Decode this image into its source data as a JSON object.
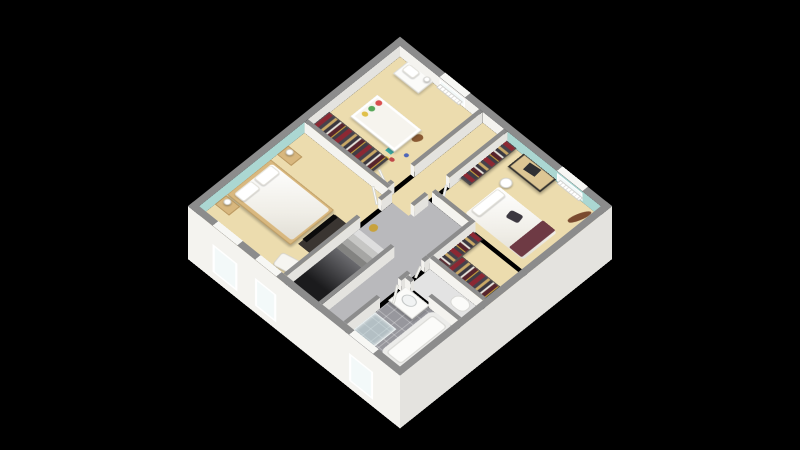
{
  "title": "3d-isometric-floor-plan-upper-storey",
  "canvas": {
    "width": 800,
    "height": 450,
    "background": "#000000"
  },
  "view": {
    "center_x": 400,
    "center_y": 217,
    "plan_size": 300,
    "tilt_deg": 37,
    "rotate_deg": 45,
    "wall_height": 18,
    "exterior_drop": 70
  },
  "palette": {
    "wall_top": "#8c8c8c",
    "wall_face": "#f4f3ef",
    "wall_face_shade": "#e4e3df",
    "teal": "#abd7d2",
    "beige": "#ecdcae",
    "hall_gray": "#b9b9bc",
    "wc_floor": "#e3e3e3",
    "window_seg": "#f7f7f4",
    "void_dark": "#1b1b1d",
    "void_light": "#6a6a6e",
    "clothes_red": "#8c2833",
    "clothes_dark": "#45424c",
    "clothes_tan": "#c9a866",
    "hanger_gold": "#d9b13f"
  },
  "rooms": [
    {
      "id": "nursery",
      "contents": "crib, changing dresser, open wardrobe, teddy bear, toys, radiator, window"
    },
    {
      "id": "corridor",
      "contents": "landing corridor to nursery and bedroom-2 doors"
    },
    {
      "id": "bedroom-2",
      "contents": "desk, stool, bed with maroon throw, open wardrobe, guitar, radiator, window, closet nook"
    },
    {
      "id": "master-bedroom",
      "contents": "double bed, two nightstands with lamps, tv, armchair, two windows, teal accent wall"
    },
    {
      "id": "hall",
      "contents": "staircase down, gold decor object"
    },
    {
      "id": "wc",
      "contents": "toilet"
    },
    {
      "id": "bathroom",
      "contents": "vanity sink, bathtub, shower, tiled floor, window"
    }
  ],
  "floors": [
    {
      "id": "hall-floor",
      "rect": [
        132,
        115,
        80,
        177
      ],
      "color": "hall_gray"
    },
    {
      "id": "nursery-floor",
      "rect": [
        8,
        8,
        112,
        130
      ],
      "color": "beige"
    },
    {
      "id": "corridor-floor",
      "rect": [
        125,
        8,
        30,
        135
      ],
      "color": "beige"
    },
    {
      "id": "bedroom2-floor",
      "rect": [
        160,
        8,
        132,
        102
      ],
      "color": "beige"
    },
    {
      "id": "closet-nook-floor",
      "rect": [
        217,
        115,
        75,
        55
      ],
      "color": "beige"
    },
    {
      "id": "master-floor",
      "rect": [
        8,
        143,
        119,
        149
      ],
      "color": "beige"
    },
    {
      "id": "wc-floor",
      "rect": [
        217,
        175,
        75,
        30
      ],
      "color": "wc_floor"
    },
    {
      "id": "bathroom-floor",
      "rect": [
        217,
        210,
        75,
        82
      ],
      "color": "",
      "cls": "tile"
    }
  ],
  "stairs": {
    "treads": [
      {
        "rect": [
          132,
          190,
          45,
          8
        ],
        "color": "#dedede"
      },
      {
        "rect": [
          132,
          198,
          45,
          8
        ],
        "color": "#c6c6c4"
      },
      {
        "rect": [
          132,
          206,
          45,
          8
        ],
        "color": "#a6a6a4"
      },
      {
        "rect": [
          132,
          214,
          45,
          8
        ],
        "color": "#838381"
      }
    ],
    "void": {
      "rect": [
        132,
        222,
        45,
        70
      ]
    }
  },
  "walls": [
    {
      "id": "exterior-wall-north",
      "rect": [
        0,
        0,
        300,
        8
      ],
      "faces": []
    },
    {
      "id": "exterior-wall-west",
      "rect": [
        0,
        0,
        8,
        300
      ],
      "faces": []
    },
    {
      "id": "exterior-wall-south",
      "rect": [
        0,
        292,
        300,
        8
      ],
      "faces": []
    },
    {
      "id": "exterior-wall-east",
      "rect": [
        292,
        0,
        8,
        300
      ],
      "faces": []
    },
    {
      "id": "nursery-east-wall",
      "rect": [
        120,
        8,
        5,
        97
      ],
      "faces": [
        "s",
        "e"
      ]
    },
    {
      "id": "nursery-east-wall-stub",
      "rect": [
        120,
        133,
        5,
        5
      ],
      "faces": [
        "s",
        "e"
      ]
    },
    {
      "id": "nursery-south-wall",
      "rect": [
        8,
        138,
        117,
        5
      ],
      "faces": [
        "s",
        "e"
      ]
    },
    {
      "id": "bedroom2-west-wall-a",
      "rect": [
        155,
        8,
        5,
        82
      ],
      "faces": [
        "s",
        "e"
      ]
    },
    {
      "id": "bedroom2-west-wall-b",
      "rect": [
        155,
        120,
        5,
        20
      ],
      "faces": [
        "s",
        "e"
      ]
    },
    {
      "id": "bedroom2-south-wall",
      "rect": [
        160,
        110,
        52,
        5
      ],
      "faces": [
        "s",
        "e"
      ]
    },
    {
      "id": "closet-nook-west-wall",
      "rect": [
        212,
        110,
        5,
        65
      ],
      "faces": [
        "s",
        "e"
      ]
    },
    {
      "id": "closet-nook-south-wall",
      "rect": [
        217,
        170,
        75,
        5
      ],
      "faces": [
        "s"
      ]
    },
    {
      "id": "wc-west-wall-a",
      "rect": [
        212,
        175,
        5,
        7
      ],
      "faces": [
        "s",
        "e"
      ]
    },
    {
      "id": "wc-west-wall-b",
      "rect": [
        212,
        202,
        5,
        13
      ],
      "faces": [
        "s",
        "e"
      ]
    },
    {
      "id": "bathroom-north-wall-a",
      "rect": [
        217,
        205,
        8,
        5
      ],
      "faces": [
        "s",
        "e"
      ]
    },
    {
      "id": "bathroom-north-wall-b",
      "rect": [
        250,
        205,
        42,
        5
      ],
      "faces": [
        "s"
      ]
    },
    {
      "id": "bathroom-west-wall",
      "rect": [
        212,
        245,
        5,
        47
      ],
      "faces": [
        "e"
      ]
    },
    {
      "id": "master-east-wall-a",
      "rect": [
        127,
        143,
        5,
        15
      ],
      "faces": [
        "s",
        "e"
      ]
    },
    {
      "id": "master-east-wall-b",
      "rect": [
        127,
        188,
        5,
        104
      ],
      "faces": [
        "e"
      ]
    },
    {
      "id": "stair-half-wall",
      "rect": [
        177,
        190,
        5,
        102
      ],
      "faces": [
        "e",
        "s"
      ]
    }
  ],
  "exterior_faces": [
    {
      "id": "exterior-face-south",
      "axis": "x",
      "x": 0,
      "y": 300,
      "len": 300,
      "color": "wall_face",
      "windows": [
        {
          "id": "master-window-1-panel",
          "at": 35,
          "w": 35
        },
        {
          "id": "master-window-2-panel",
          "at": 95,
          "w": 30
        },
        {
          "id": "bathroom-window-panel",
          "at": 228,
          "w": 34
        }
      ]
    },
    {
      "id": "exterior-face-east",
      "axis": "y",
      "x": 300,
      "y": 0,
      "len": 300,
      "color": "wall_face_shade",
      "windows": []
    }
  ],
  "inner_faces": [
    {
      "id": "nursery-north-wall-face",
      "axis": "x",
      "x": 8,
      "y": 8,
      "len": 112,
      "color": "wall_face",
      "win": {
        "at": 56,
        "w": 36
      }
    },
    {
      "id": "corridor-north-wall-face",
      "axis": "x",
      "x": 125,
      "y": 8,
      "len": 30,
      "color": "wall_face"
    },
    {
      "id": "bedroom2-accent-wall",
      "axis": "x",
      "x": 160,
      "y": 8,
      "len": 132,
      "color": "teal",
      "win": {
        "at": 70,
        "w": 36
      }
    },
    {
      "id": "nursery-west-wall-face",
      "axis": "y",
      "x": 8,
      "y": 8,
      "len": 130,
      "color": "wall_face_shade"
    },
    {
      "id": "master-accent-wall",
      "axis": "y",
      "x": 8,
      "y": 143,
      "len": 149,
      "color": "teal"
    }
  ],
  "windows_top": [
    {
      "id": "nursery-window-top",
      "rect": [
        64,
        0,
        36,
        8
      ]
    },
    {
      "id": "bedroom2-window-top",
      "rect": [
        230,
        0,
        36,
        8
      ]
    },
    {
      "id": "master-window-1-top",
      "rect": [
        35,
        292,
        35,
        8
      ]
    },
    {
      "id": "master-window-2-top",
      "rect": [
        95,
        292,
        30,
        8
      ]
    },
    {
      "id": "bathroom-window-top",
      "rect": [
        228,
        292,
        34,
        8
      ]
    }
  ],
  "furniture": [
    {
      "id": "changing-dresser",
      "rect": [
        22,
        10,
        36,
        22
      ],
      "cls": "white-furn",
      "z": 8
    },
    {
      "id": "changing-pad",
      "rect": [
        26,
        13,
        16,
        11
      ],
      "cls": "pillow",
      "z": 10
    },
    {
      "id": "nursery-lamp",
      "rect": [
        50,
        12,
        7,
        7
      ],
      "cls": "lamp",
      "z": 12
    },
    {
      "id": "nursery-radiator",
      "rect": [
        66,
        9,
        32,
        6
      ],
      "cls": "radiator",
      "z": 10
    },
    {
      "id": "crib",
      "rect": [
        30,
        62,
        62,
        38
      ],
      "cls": "crib",
      "z": 8
    },
    {
      "id": "crib-toy-red",
      "rect": [
        37,
        67,
        7,
        7
      ],
      "cls": "ellip",
      "color": "#d94f4f",
      "z": 12
    },
    {
      "id": "crib-toy-green",
      "rect": [
        37,
        77,
        7,
        7
      ],
      "cls": "ellip",
      "color": "#58a85a",
      "z": 12
    },
    {
      "id": "crib-toy-yellow",
      "rect": [
        37,
        87,
        7,
        6
      ],
      "cls": "ellip",
      "color": "#e0c04a",
      "z": 12
    },
    {
      "id": "nursery-wardrobe",
      "rect": [
        12,
        112,
        84,
        23
      ],
      "cls": "clothes-h",
      "z": 10
    },
    {
      "id": "teddy-bear",
      "rect": [
        90,
        64,
        9,
        12
      ],
      "cls": "teddy",
      "z": 4,
      "rot": 25
    },
    {
      "id": "toy-teal-box",
      "rect": [
        82,
        96,
        8,
        7
      ],
      "color": "#3aa6a0",
      "z": 3
    },
    {
      "id": "toy-red",
      "rect": [
        92,
        104,
        6,
        5
      ],
      "cls": "ellip",
      "color": "#c04848",
      "z": 3
    },
    {
      "id": "toy-blue",
      "rect": [
        99,
        90,
        5,
        5
      ],
      "cls": "ellip",
      "color": "#4e66b8",
      "z": 3
    },
    {
      "id": "toy-gold",
      "rect": [
        87,
        107,
        6,
        4
      ],
      "cls": "ellip",
      "color": "#d9b13f",
      "z": 3
    },
    {
      "id": "bedroom2-wardrobe",
      "rect": [
        160,
        12,
        17,
        66
      ],
      "cls": "clothes-v",
      "z": 10
    },
    {
      "id": "desk",
      "rect": [
        186,
        10,
        46,
        24
      ],
      "cls": "desk",
      "z": 9
    },
    {
      "id": "desk-laptop",
      "rect": [
        200,
        15,
        15,
        11
      ],
      "color": "#2f2f33",
      "z": 11,
      "rot": -6
    },
    {
      "id": "desk-stool",
      "rect": [
        191,
        41,
        13,
        13
      ],
      "cls": "lamp",
      "z": 5
    },
    {
      "id": "bedroom2-radiator",
      "rect": [
        236,
        9,
        32,
        6
      ],
      "cls": "radiator",
      "z": 10
    },
    {
      "id": "guitar",
      "rect": [
        275,
        12,
        8,
        26
      ],
      "cls": "guitar",
      "z": 4,
      "rot": 18
    },
    {
      "id": "bedroom2-bed",
      "rect": [
        196,
        56,
        82,
        48
      ],
      "cls": "duvet",
      "z": 6
    },
    {
      "id": "bedroom2-pillow",
      "rect": [
        198,
        60,
        12,
        38
      ],
      "cls": "pillow",
      "z": 8
    },
    {
      "id": "bedroom2-throw",
      "rect": [
        258,
        56,
        18,
        48
      ],
      "cls": "throw",
      "z": 8
    },
    {
      "id": "bedroom2-bag",
      "rect": [
        228,
        68,
        15,
        11
      ],
      "cls": "bag",
      "z": 9,
      "rot": -12
    },
    {
      "id": "closet-wardrobe-west",
      "rect": [
        218,
        116,
        16,
        50
      ],
      "cls": "clothes-v",
      "z": 10
    },
    {
      "id": "closet-wardrobe-south",
      "rect": [
        234,
        146,
        54,
        22
      ],
      "cls": "clothes-h",
      "z": 10
    },
    {
      "id": "master-bed-frame",
      "rect": [
        10,
        193,
        90,
        62
      ],
      "cls": "bedframe",
      "z": 5
    },
    {
      "id": "master-duvet",
      "rect": [
        16,
        197,
        82,
        54
      ],
      "cls": "duvet",
      "z": 7
    },
    {
      "id": "master-pillow-1",
      "rect": [
        17,
        200,
        14,
        24
      ],
      "cls": "pillow",
      "z": 9
    },
    {
      "id": "master-pillow-2",
      "rect": [
        17,
        228,
        14,
        24
      ],
      "cls": "pillow",
      "z": 9
    },
    {
      "id": "nightstand-north",
      "rect": [
        12,
        170,
        20,
        16
      ],
      "cls": "wood",
      "z": 8
    },
    {
      "id": "nightstand-north-lamp",
      "rect": [
        17,
        173,
        8,
        8
      ],
      "cls": "lamp",
      "z": 12
    },
    {
      "id": "nightstand-south",
      "rect": [
        12,
        258,
        20,
        16
      ],
      "cls": "wood",
      "z": 8
    },
    {
      "id": "nightstand-south-lamp",
      "rect": [
        17,
        261,
        8,
        8
      ],
      "cls": "lamp",
      "z": 12
    },
    {
      "id": "tv-unit",
      "rect": [
        106,
        198,
        16,
        52
      ],
      "cls": "tvunit",
      "z": 8
    },
    {
      "id": "tv-screen",
      "rect": [
        108,
        202,
        6,
        44
      ],
      "cls": "tv",
      "z": 14
    },
    {
      "id": "master-armchair",
      "rect": [
        102,
        264,
        24,
        19
      ],
      "cls": "chair",
      "z": 5,
      "rot": -12
    },
    {
      "id": "hall-gold-decor",
      "rect": [
        138,
        175,
        9,
        10
      ],
      "cls": "gold",
      "z": 3,
      "rot": -20
    },
    {
      "id": "vanity",
      "rect": [
        220,
        212,
        34,
        25
      ],
      "cls": "white-furn",
      "z": 9
    },
    {
      "id": "vanity-sink",
      "rect": [
        228,
        217,
        17,
        13
      ],
      "cls": "sink",
      "z": 11
    },
    {
      "id": "bathtub",
      "rect": [
        259,
        213,
        31,
        76
      ],
      "cls": "tub",
      "z": 8
    },
    {
      "id": "shower",
      "rect": [
        220,
        255,
        30,
        34
      ],
      "cls": "shower",
      "z": 6
    },
    {
      "id": "toilet",
      "rect": [
        262,
        179,
        21,
        16
      ],
      "cls": "toilet",
      "z": 6
    },
    {
      "id": "nursery-door",
      "rect": [
        99,
        127,
        24,
        3
      ],
      "cls": "door-leaf",
      "z": 11,
      "rot": 25
    },
    {
      "id": "bedroom2-door",
      "rect": [
        160,
        93,
        24,
        3
      ],
      "cls": "door-leaf",
      "z": 11,
      "rot": 55
    },
    {
      "id": "master-door",
      "rect": [
        105,
        160,
        24,
        3
      ],
      "cls": "door-leaf-r",
      "z": 11,
      "rot": 35
    },
    {
      "id": "bathroom-door",
      "rect": [
        214,
        216,
        24,
        3
      ],
      "cls": "door-leaf",
      "z": 11,
      "rot": 55
    },
    {
      "id": "wc-door",
      "rect": [
        214,
        183,
        16,
        3
      ],
      "cls": "door-leaf",
      "z": 11,
      "rot": 65
    }
  ]
}
